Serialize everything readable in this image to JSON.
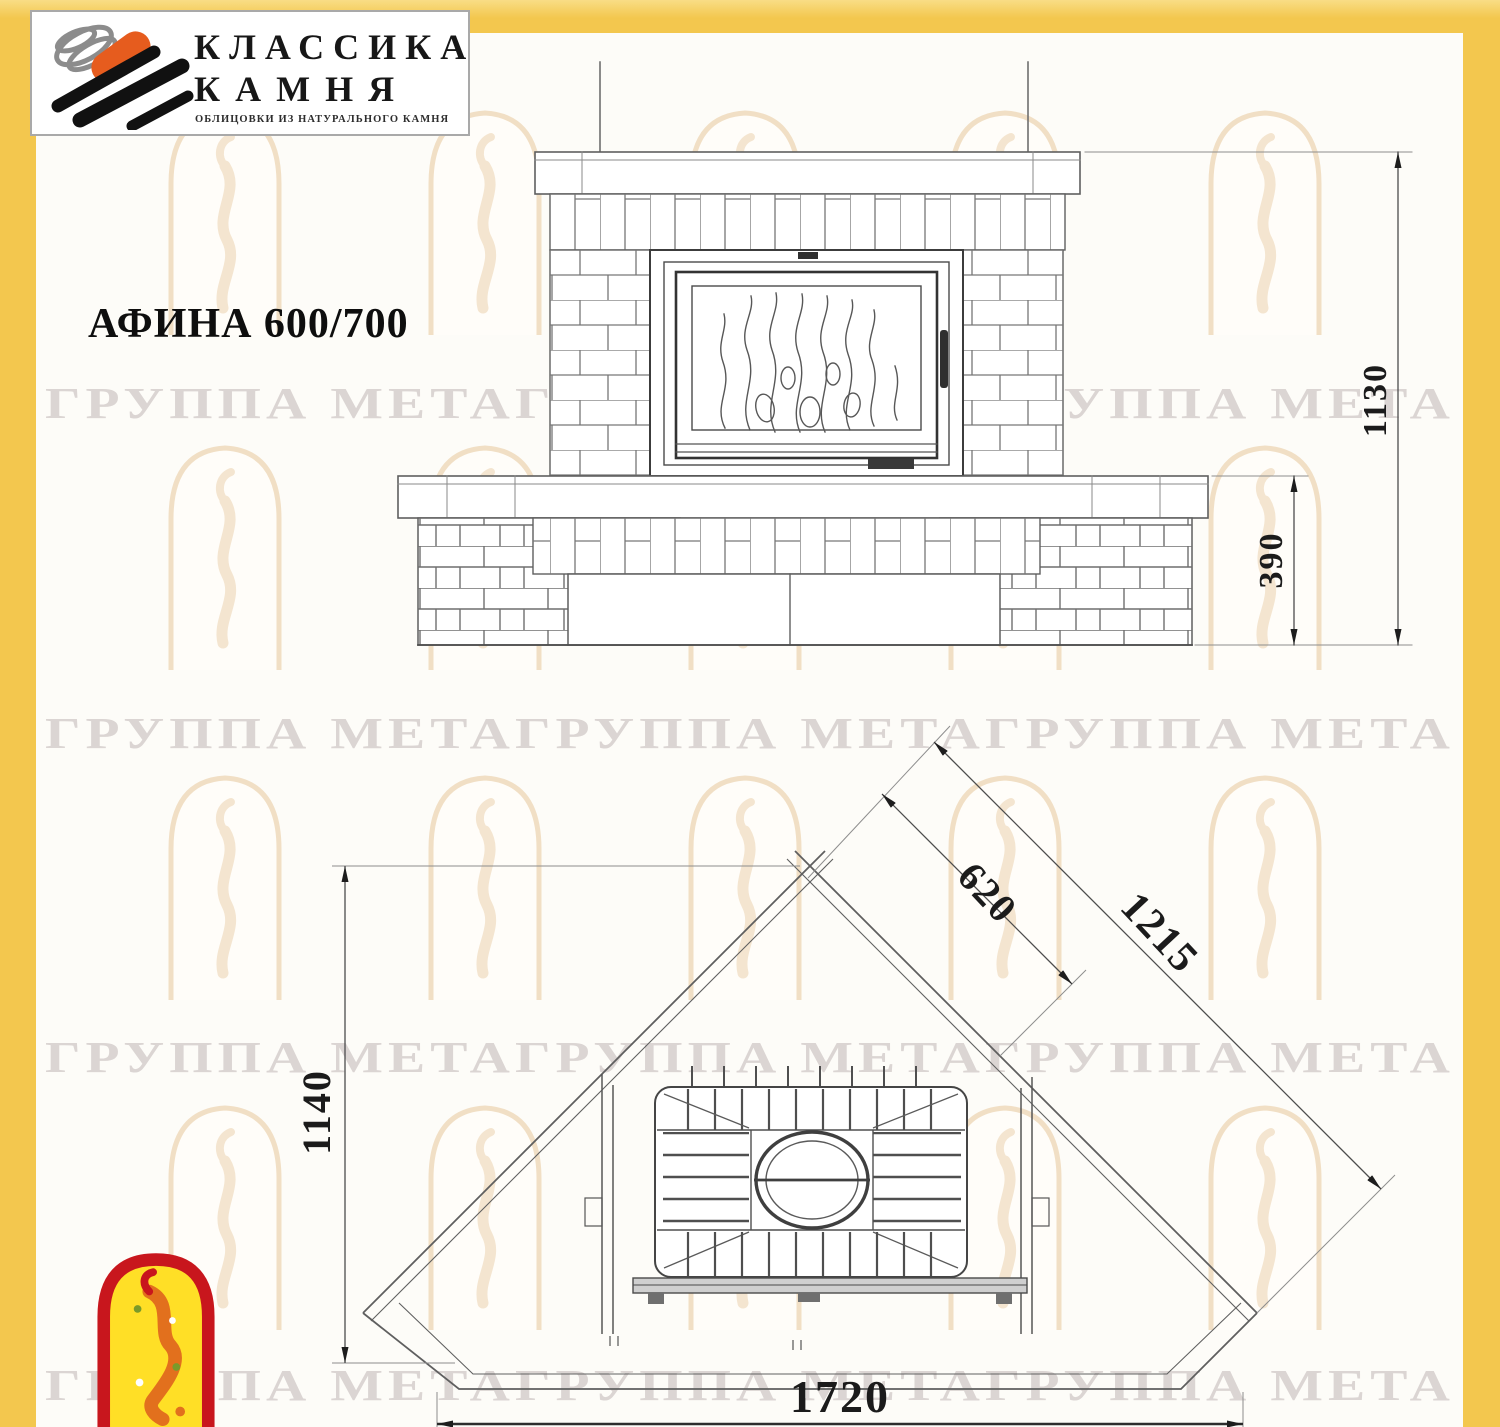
{
  "header_logo": {
    "brand_line1": "КЛАССИКА",
    "brand_line2": "КАМНЯ",
    "tagline": "ОБЛИЦОВКИ ИЗ НАТУРАЛЬНОГО КАМНЯ"
  },
  "title": "АФИНА 600/700",
  "watermark": {
    "text": "ГРУППА МЕТАГРУППА МЕТАГРУППА МЕТА"
  },
  "front_view": {
    "height_total_mm": "1130",
    "height_base_mm": "390"
  },
  "plan_view": {
    "depth_mm": "1140",
    "front_width_mm": "1720",
    "hearth_diagonal_mm": "620",
    "back_wall_mm": "1215"
  },
  "colors": {
    "frame_yellow": "#f3c74e",
    "logo_orange": "#e65c1e",
    "badge_red": "#c8161d",
    "badge_yellow": "#ffdf26",
    "watermark_gray": "#dbd5d3",
    "drawing_line": "#5f5f5f"
  }
}
